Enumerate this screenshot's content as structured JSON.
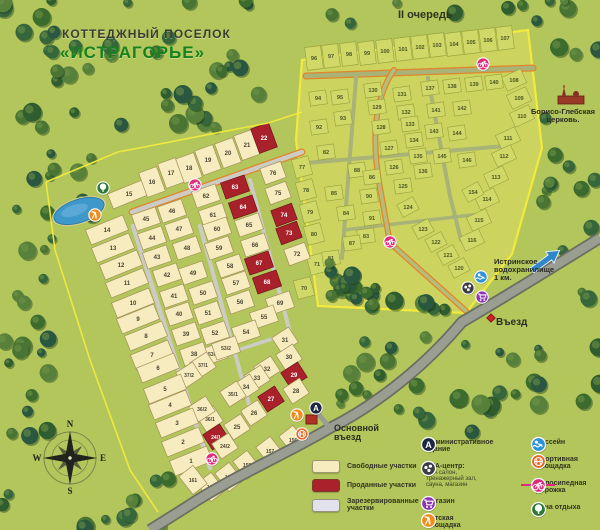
{
  "title": {
    "line1": "КОТТЕДЖНЫЙ ПОСЕЛОК",
    "line2": "«ИСТРАГОРЬЕ»"
  },
  "labels": {
    "phase2": "II очередь",
    "church": "Борисо-Глебская церковь.",
    "reservoir": "Истринское водохранилище 1 км.",
    "entrance": "Въезд",
    "main_entrance": "Основной въезд"
  },
  "compass": {
    "n": "N",
    "e": "E",
    "s": "S",
    "w": "W"
  },
  "legend_areas": [
    {
      "label": "Свободные участки",
      "color": "#f6ecc0"
    },
    {
      "label": "Проданные участки",
      "color": "#a8212b"
    },
    {
      "label": "Зарезервированные участки",
      "color": "#e2e2ec"
    }
  ],
  "legend_icons": [
    {
      "icon": "admin",
      "label": "Административное здание",
      "color": "#1d2742"
    },
    {
      "icon": "spa",
      "label": "SPA-центр:",
      "sub": "SPA салон, тренажерный зал, сауна, магазин",
      "color": "#3c3c44"
    },
    {
      "icon": "shop",
      "label": "Магазин",
      "color": "#8d35b5"
    },
    {
      "icon": "playground",
      "label": "Детская площадка",
      "color": "#f08c1e"
    },
    {
      "icon": "pool",
      "label": "Бассейн",
      "color": "#2d93d6"
    },
    {
      "icon": "sport",
      "label": "Спортивная площадка",
      "color": "#e8641f"
    },
    {
      "icon": "bike",
      "label": "Велосипедная дорожка",
      "color": "#e02a7c"
    },
    {
      "icon": "rest",
      "label": "Зона отдыха",
      "color": "#2c7a35"
    }
  ],
  "map": {
    "colors": {
      "background": "#b2c65c",
      "free_plot": "#f6ecc0",
      "sold_plot": "#a8212b",
      "reserved_plot": "#e2e2ec",
      "phase2_area": "#ccd45f",
      "boundary_yellow": "#f2ea3c",
      "water": "#3f98ca",
      "road": "#9a9d92",
      "bike_route": "#e0872c"
    },
    "phase1_plots": [
      [
        "15",
        129,
        194,
        0
      ],
      [
        "16",
        152,
        182,
        0
      ],
      [
        "17",
        171,
        173,
        0
      ],
      [
        "18",
        189,
        168,
        0
      ],
      [
        "19",
        208,
        160,
        0
      ],
      [
        "20",
        228,
        153,
        0
      ],
      [
        "21",
        247,
        145,
        0
      ],
      [
        "22",
        264,
        138,
        1
      ],
      [
        "76",
        273,
        173,
        0
      ],
      [
        "75",
        278,
        193,
        0
      ],
      [
        "74",
        284,
        215,
        1
      ],
      [
        "73",
        289,
        233,
        1
      ],
      [
        "72",
        297,
        254,
        0
      ],
      [
        "63",
        235,
        187,
        1
      ],
      [
        "64",
        243,
        207,
        1
      ],
      [
        "65",
        249,
        225,
        0
      ],
      [
        "66",
        255,
        245,
        0
      ],
      [
        "67",
        259,
        263,
        1
      ],
      [
        "68",
        267,
        282,
        1
      ],
      [
        "69",
        280,
        303,
        0
      ],
      [
        "62",
        206,
        196,
        0
      ],
      [
        "61",
        213,
        215,
        0
      ],
      [
        "60",
        217,
        229,
        0
      ],
      [
        "59",
        219,
        248,
        0
      ],
      [
        "58",
        230,
        266,
        0
      ],
      [
        "57",
        236,
        283,
        0
      ],
      [
        "56",
        240,
        302,
        0
      ],
      [
        "55",
        264,
        317,
        0
      ],
      [
        "54",
        246,
        332,
        0
      ],
      [
        "46",
        172,
        211,
        0
      ],
      [
        "47",
        179,
        229,
        0
      ],
      [
        "48",
        187,
        248,
        0
      ],
      [
        "49",
        193,
        273,
        0
      ],
      [
        "50",
        203,
        293,
        0
      ],
      [
        "51",
        208,
        313,
        0
      ],
      [
        "52",
        215,
        333,
        0
      ],
      [
        "53/1",
        213,
        354,
        0
      ],
      [
        "53/2",
        226,
        348,
        0
      ],
      [
        "45",
        146,
        219,
        0
      ],
      [
        "44",
        152,
        238,
        0
      ],
      [
        "43",
        157,
        257,
        0
      ],
      [
        "42",
        167,
        275,
        0
      ],
      [
        "41",
        174,
        296,
        0
      ],
      [
        "40",
        179,
        314,
        0
      ],
      [
        "39",
        186,
        334,
        0
      ],
      [
        "38",
        194,
        354,
        0
      ],
      [
        "37/1",
        203,
        365,
        0
      ],
      [
        "37/2",
        189,
        375,
        0
      ],
      [
        "36/1",
        210,
        419,
        0
      ],
      [
        "36/2",
        202,
        409,
        0
      ],
      [
        "14",
        107,
        230,
        0
      ],
      [
        "13",
        113,
        248,
        0
      ],
      [
        "12",
        121,
        265,
        0
      ],
      [
        "11",
        127,
        283,
        0
      ],
      [
        "10",
        133,
        303,
        0
      ],
      [
        "9",
        138,
        319,
        0
      ],
      [
        "8",
        146,
        336,
        0
      ],
      [
        "7",
        152,
        355,
        0
      ],
      [
        "6",
        158,
        368,
        0
      ],
      [
        "5",
        165,
        389,
        0
      ],
      [
        "4",
        170,
        405,
        0
      ],
      [
        "3",
        177,
        423,
        0
      ],
      [
        "2",
        183,
        442,
        0
      ],
      [
        "1",
        191,
        461,
        0
      ],
      [
        "31",
        285,
        340,
        0
      ],
      [
        "30",
        289,
        357,
        0
      ],
      [
        "32",
        267,
        369,
        0
      ],
      [
        "33",
        257,
        378,
        0
      ],
      [
        "34",
        246,
        387,
        0
      ],
      [
        "35/1",
        233,
        394,
        0
      ],
      [
        "29",
        294,
        375,
        1
      ],
      [
        "28",
        296,
        391,
        0
      ],
      [
        "27",
        271,
        399,
        1
      ],
      [
        "26",
        254,
        413,
        0
      ],
      [
        "25",
        237,
        427,
        0
      ],
      [
        "24/1",
        216,
        437,
        1
      ],
      [
        "24/2",
        225,
        446,
        0
      ],
      [
        "156",
        293,
        440,
        0
      ],
      [
        "157",
        270,
        451,
        0
      ],
      [
        "158",
        247,
        465,
        0
      ],
      [
        "159",
        229,
        477,
        0
      ],
      [
        "160",
        211,
        487,
        0
      ],
      [
        "161",
        193,
        480,
        0
      ]
    ],
    "phase2_plots": [
      [
        "96",
        314,
        58
      ],
      [
        "97",
        331,
        56
      ],
      [
        "98",
        349,
        54
      ],
      [
        "99",
        367,
        53
      ],
      [
        "100",
        385,
        51
      ],
      [
        "101",
        403,
        49
      ],
      [
        "102",
        420,
        47
      ],
      [
        "103",
        437,
        45
      ],
      [
        "104",
        454,
        44
      ],
      [
        "105",
        471,
        42
      ],
      [
        "106",
        488,
        40
      ],
      [
        "107",
        505,
        38
      ],
      [
        "108",
        514,
        80
      ],
      [
        "109",
        519,
        98
      ],
      [
        "110",
        522,
        116
      ],
      [
        "111",
        508,
        138
      ],
      [
        "112",
        504,
        156
      ],
      [
        "113",
        496,
        177
      ],
      [
        "114",
        487,
        199
      ],
      [
        "115",
        479,
        220
      ],
      [
        "116",
        472,
        240
      ],
      [
        "77",
        302,
        167
      ],
      [
        "78",
        306,
        190
      ],
      [
        "79",
        310,
        212
      ],
      [
        "80",
        314,
        234
      ],
      [
        "71",
        317,
        264
      ],
      [
        "70",
        304,
        288
      ],
      [
        "94",
        318,
        98
      ],
      [
        "95",
        340,
        97
      ],
      [
        "92",
        319,
        127
      ],
      [
        "93",
        343,
        118
      ],
      [
        "82",
        326,
        152
      ],
      [
        "88",
        357,
        170
      ],
      [
        "86",
        372,
        177
      ],
      [
        "85",
        334,
        193
      ],
      [
        "84",
        346,
        213
      ],
      [
        "90",
        369,
        196
      ],
      [
        "91",
        372,
        218
      ],
      [
        "83",
        366,
        236
      ],
      [
        "87",
        352,
        243
      ],
      [
        "81",
        331,
        258
      ],
      [
        "130",
        373,
        90
      ],
      [
        "129",
        377,
        107
      ],
      [
        "128",
        381,
        127
      ],
      [
        "127",
        389,
        148
      ],
      [
        "126",
        394,
        167
      ],
      [
        "125",
        403,
        186
      ],
      [
        "131",
        402,
        94
      ],
      [
        "132",
        406,
        112
      ],
      [
        "133",
        410,
        124
      ],
      [
        "134",
        414,
        140
      ],
      [
        "135",
        418,
        156
      ],
      [
        "136",
        423,
        171
      ],
      [
        "137",
        430,
        88
      ],
      [
        "138",
        452,
        86
      ],
      [
        "139",
        474,
        84
      ],
      [
        "140",
        494,
        82
      ],
      [
        "141",
        436,
        110
      ],
      [
        "142",
        462,
        108
      ],
      [
        "143",
        434,
        131
      ],
      [
        "144",
        457,
        133
      ],
      [
        "145",
        442,
        156
      ],
      [
        "146",
        467,
        160
      ],
      [
        "154",
        473,
        192
      ],
      [
        "124",
        408,
        207
      ],
      [
        "123",
        423,
        229
      ],
      [
        "122",
        436,
        242
      ],
      [
        "121",
        448,
        255
      ],
      [
        "120",
        459,
        268
      ]
    ],
    "map_icons": [
      [
        "rest",
        103,
        188
      ],
      [
        "playground",
        95,
        215
      ],
      [
        "bike",
        195,
        185
      ],
      [
        "bike",
        483,
        64
      ],
      [
        "bike",
        390,
        242
      ],
      [
        "bike",
        212,
        459
      ],
      [
        "admin",
        316,
        408
      ],
      [
        "playground",
        297,
        415
      ],
      [
        "sport",
        302,
        434
      ],
      [
        "pool",
        481,
        277
      ],
      [
        "spa",
        468,
        288
      ],
      [
        "shop",
        482,
        297
      ]
    ]
  }
}
